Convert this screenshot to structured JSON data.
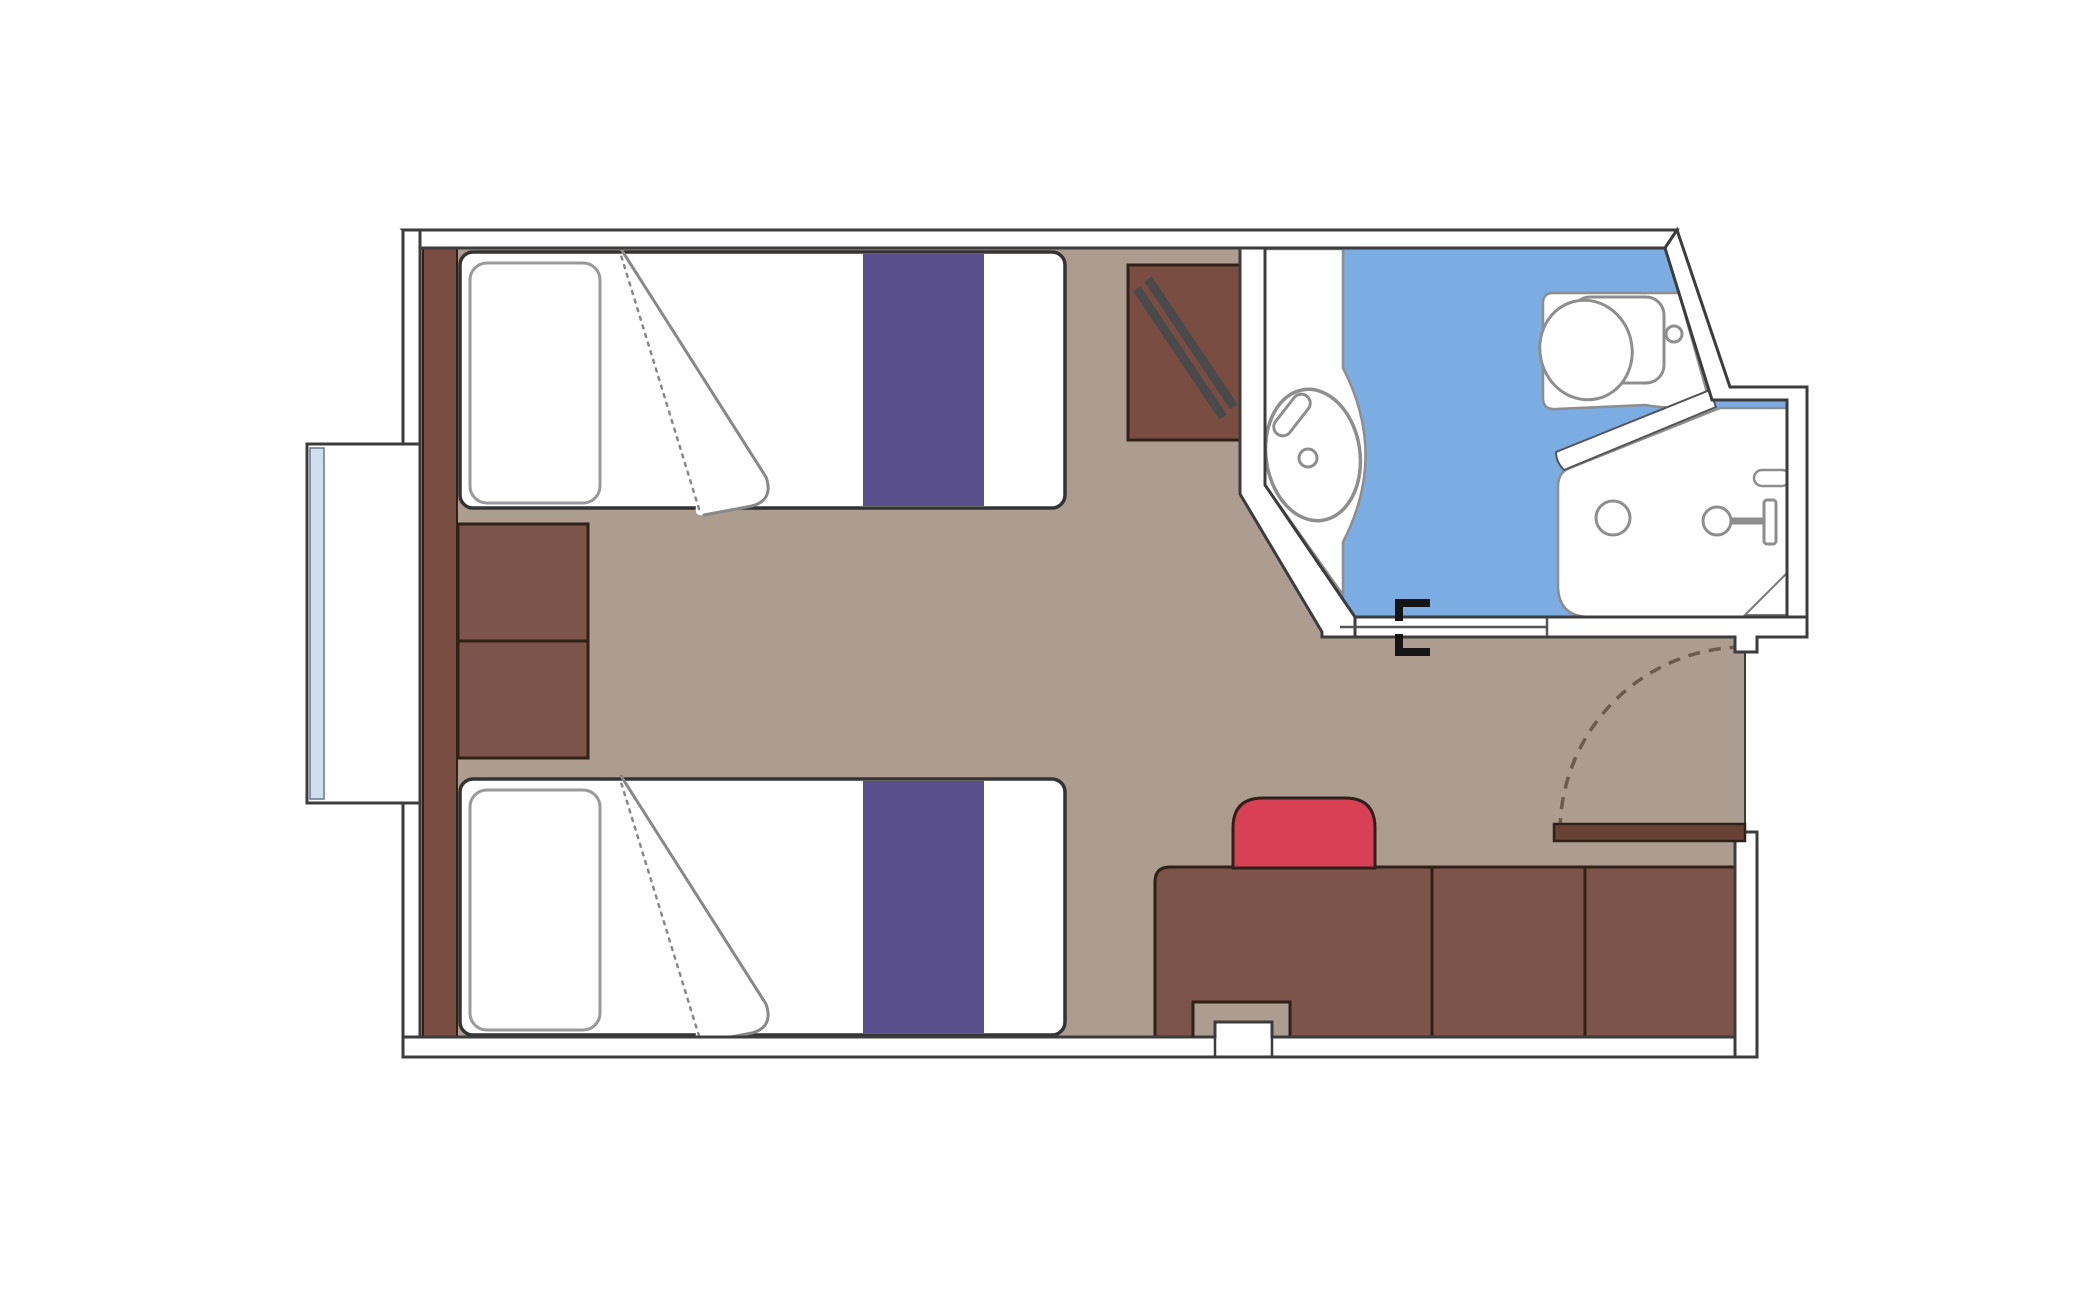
{
  "title": "Twin cabin floor plan with bathroom",
  "palette": {
    "background": "#ffffff",
    "floor": "#ad9d90",
    "wall_fill": "#ffffff",
    "wall_outline": "#3c3c3c",
    "furniture": "#7c5449",
    "furniture_dark": "#7a4d42",
    "furniture_outline": "#2f2018",
    "bed_linen": "#ffffff",
    "bed_outline": "#333333",
    "bed_runner": "#594f8c",
    "pillow_outline": "#999999",
    "blanket_outline": "#888888",
    "bathroom_floor": "#7bace2",
    "fixture_fill": "#ffffff",
    "fixture_outline": "#8e8e8e",
    "chair": "#d84058",
    "door_leaf": "#694235",
    "window_glass": "#d0dff0",
    "glass_outline": "#667788",
    "rod": "#4a4a4a",
    "swing_dash": "#6b5a50",
    "bracket": "#151515",
    "hatch_line": "#777777",
    "panel_line": "#555555"
  },
  "rooms": [
    {
      "id": "cabin",
      "label": "cabin floor"
    },
    {
      "id": "bathroom",
      "label": "bathroom floor"
    }
  ],
  "furniture": [
    {
      "id": "bed-1",
      "label": "twin bed with pillow, folded duvet and purple runner"
    },
    {
      "id": "bed-2",
      "label": "twin bed with pillow, folded duvet and purple runner"
    },
    {
      "id": "nightstand",
      "label": "two-drawer nightstand between beds"
    },
    {
      "id": "headboard-panel",
      "label": "headboard wall panel"
    },
    {
      "id": "window",
      "label": "picture window"
    },
    {
      "id": "luggage-bench",
      "label": "luggage bench with folding rod"
    },
    {
      "id": "desk-run",
      "label": "desk and cabinet run"
    },
    {
      "id": "chair",
      "label": "red desk chair"
    },
    {
      "id": "entrance-door",
      "label": "entrance door with swing arc"
    },
    {
      "id": "bathroom-door",
      "label": "sliding bathroom door with track brackets"
    },
    {
      "id": "sink",
      "label": "washbasin on counter"
    },
    {
      "id": "toilet",
      "label": "toilet"
    },
    {
      "id": "shower",
      "label": "shower with head, drain, soap dish and hatched step"
    },
    {
      "id": "column",
      "label": "wall column notch"
    }
  ]
}
